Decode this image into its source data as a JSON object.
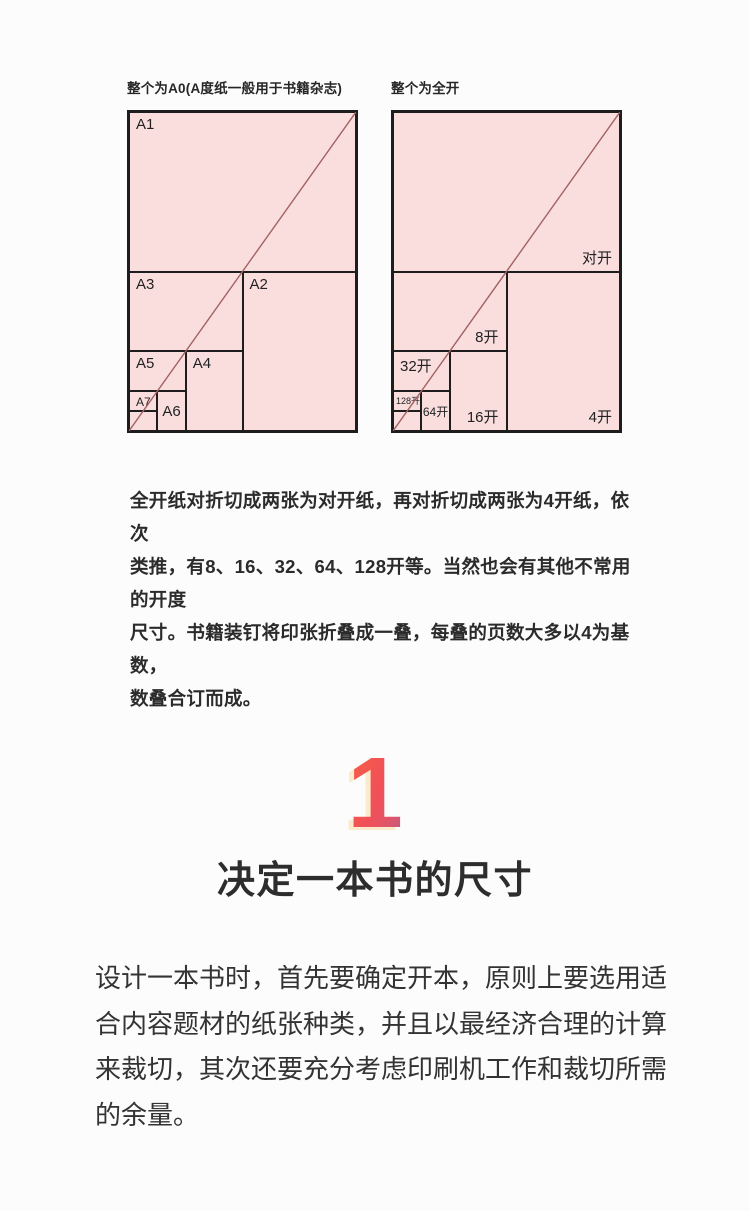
{
  "figures": {
    "colors": {
      "paper_fill": "#fadede",
      "line": "#1d1d1d",
      "diagonal": "#a26262"
    },
    "left": {
      "caption": "整个为A0(A度纸一般用于书籍杂志)",
      "cells": [
        {
          "label": "A1",
          "x": 0,
          "y": 0,
          "w": 100,
          "h": 50,
          "pos": "tl",
          "size": "l"
        },
        {
          "label": "A3",
          "x": 0,
          "y": 50,
          "w": 50,
          "h": 25,
          "pos": "tl",
          "size": "l"
        },
        {
          "label": "A2",
          "x": 50,
          "y": 50,
          "w": 50,
          "h": 50,
          "pos": "tl",
          "size": "l"
        },
        {
          "label": "A5",
          "x": 0,
          "y": 75,
          "w": 25,
          "h": 12.5,
          "pos": "tl",
          "size": "l"
        },
        {
          "label": "A4",
          "x": 25,
          "y": 75,
          "w": 25,
          "h": 25,
          "pos": "tl",
          "size": "l"
        },
        {
          "label": "A7",
          "x": 0,
          "y": 87.5,
          "w": 12.5,
          "h": 6.25,
          "pos": "tl",
          "size": "m"
        },
        {
          "label": "A6",
          "x": 12.5,
          "y": 87.5,
          "w": 12.5,
          "h": 12.5,
          "pos": "c",
          "size": "l"
        },
        {
          "label": "",
          "x": 0,
          "y": 93.75,
          "w": 12.5,
          "h": 6.25,
          "pos": "c",
          "size": "s"
        }
      ]
    },
    "right": {
      "caption": "整个为全开",
      "cells": [
        {
          "label": "对开",
          "x": 0,
          "y": 0,
          "w": 100,
          "h": 50,
          "pos": "br",
          "size": "l"
        },
        {
          "label": "8开",
          "x": 0,
          "y": 50,
          "w": 50,
          "h": 25,
          "pos": "br",
          "size": "l"
        },
        {
          "label": "4开",
          "x": 50,
          "y": 50,
          "w": 50,
          "h": 50,
          "pos": "br",
          "size": "l"
        },
        {
          "label": "32开",
          "x": 0,
          "y": 75,
          "w": 25,
          "h": 12.5,
          "pos": "tl",
          "size": "l"
        },
        {
          "label": "16开",
          "x": 25,
          "y": 75,
          "w": 25,
          "h": 25,
          "pos": "br",
          "size": "l"
        },
        {
          "label": "128开",
          "x": 0,
          "y": 87.5,
          "w": 12.5,
          "h": 6.25,
          "pos": "tl",
          "size": "s"
        },
        {
          "label": "64开",
          "x": 12.5,
          "y": 87.5,
          "w": 12.5,
          "h": 12.5,
          "pos": "c",
          "size": "m"
        },
        {
          "label": "",
          "x": 0,
          "y": 93.75,
          "w": 12.5,
          "h": 6.25,
          "pos": "c",
          "size": "s"
        }
      ]
    }
  },
  "intro_lines": [
    "全开纸对折切成两张为对开纸，再对折切成两张为4开纸，依次",
    "类推，有8、16、32、64、128开等。当然也会有其他不常用的开度",
    "尺寸。书籍装钉将印张折叠成一叠，每叠的页数大多以4为基数，",
    "数叠合订而成。"
  ],
  "section": {
    "number": "1",
    "number_colors": {
      "gradient_from": "#f65a4b",
      "gradient_to": "#a95f8b",
      "edge": "#fbeacb"
    },
    "heading": "决定一本书的尺寸",
    "body_lines": [
      "设计一本书时，首先要确定开本，原则上要选用适",
      "合内容题材的纸张种类，并且以最经济合理的计算",
      "来裁切，其次还要充分考虑印刷机工作和裁切所需",
      "的余量。"
    ]
  }
}
